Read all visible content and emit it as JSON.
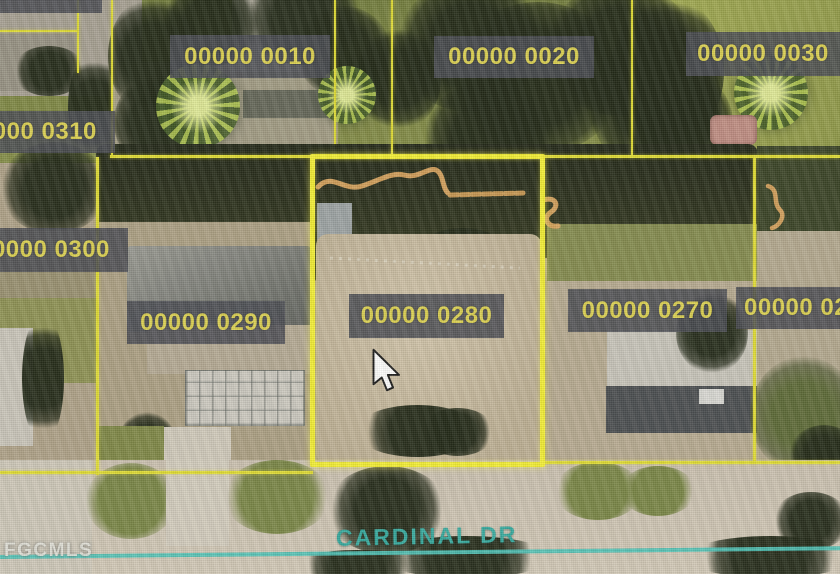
{
  "map": {
    "description": "Aerial parcel map with GIS overlay",
    "watermark": "FGCMLS",
    "street": {
      "name": "CARDINAL DR"
    },
    "highlighted_parcel": "00000 0280",
    "parcel_labels": [
      {
        "id": "parcel-0320",
        "text": "00000 0320",
        "clipped": "top-left"
      },
      {
        "id": "parcel-0010",
        "text": "00000 0010"
      },
      {
        "id": "parcel-0020",
        "text": "00000 0020"
      },
      {
        "id": "parcel-0030",
        "text": "00000 0030"
      },
      {
        "id": "parcel-0310",
        "text": "00000 0310",
        "clipped": "left"
      },
      {
        "id": "parcel-0300",
        "text": "00000 0300",
        "clipped": "left"
      },
      {
        "id": "parcel-0290",
        "text": "00000 0290"
      },
      {
        "id": "parcel-0280",
        "text": "00000 0280",
        "highlighted": true
      },
      {
        "id": "parcel-0270",
        "text": "00000 0270"
      },
      {
        "id": "parcel-026x",
        "text": "00000 02",
        "clipped": "right"
      }
    ],
    "colors": {
      "parcel_line": "#e0dc2c",
      "highlight_line": "#f4ef2c",
      "label_background": "#42444c",
      "label_text": "#dbd04b",
      "street_line": "#48c2b6",
      "street_text": "#2da79c",
      "watermark_text": "#e6e6df",
      "sand_line": "#d9a158"
    }
  }
}
